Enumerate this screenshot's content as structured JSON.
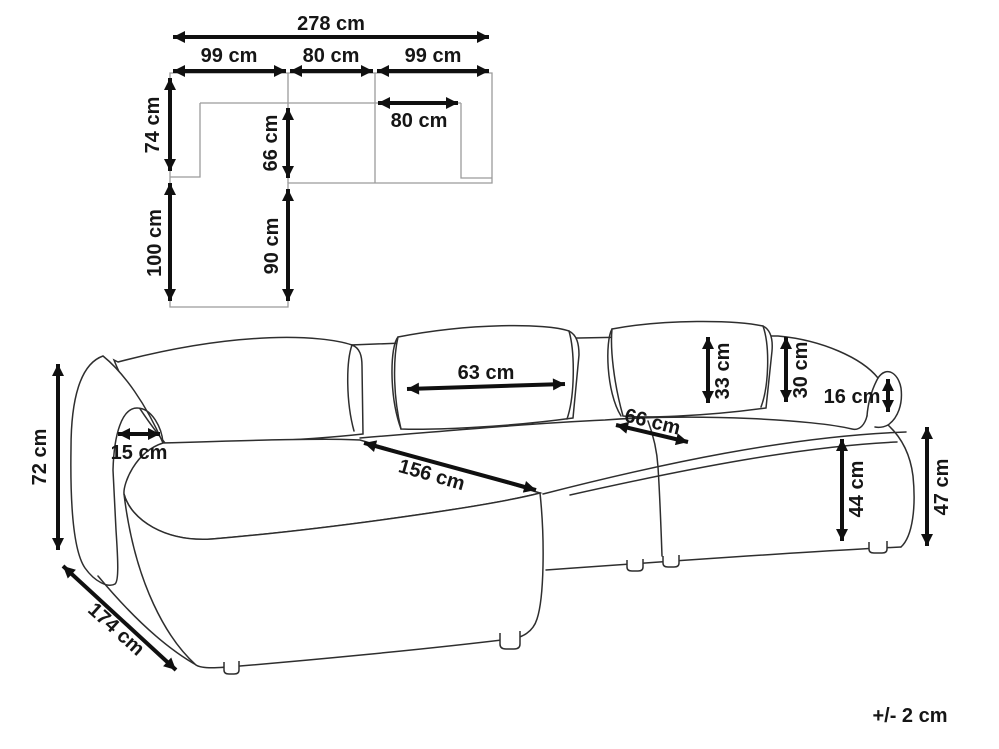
{
  "top_view": {
    "total_width": "278 cm",
    "left_module_width": "99 cm",
    "middle_module_width": "80 cm",
    "right_module_width": "99 cm",
    "inner_seat_width": "80 cm",
    "back_section_depth": "74 cm",
    "inner_seat_depth": "66 cm",
    "chaise_extension_depth": "100 cm",
    "chaise_inner_depth": "90 cm"
  },
  "sofa_view": {
    "back_height": "72 cm",
    "total_depth": "174 cm",
    "armrest_top_width": "15 cm",
    "back_cushion_width": "63 cm",
    "chaise_seat_length": "156 cm",
    "seat_depth": "66 cm",
    "back_cushion_height": "33 cm",
    "backrest_height": "30 cm",
    "armrest_rise_height": "16 cm",
    "front_seat_height": "44 cm",
    "armrest_height": "47 cm"
  },
  "footer": {
    "tolerance_note": "+/- 2 cm"
  }
}
